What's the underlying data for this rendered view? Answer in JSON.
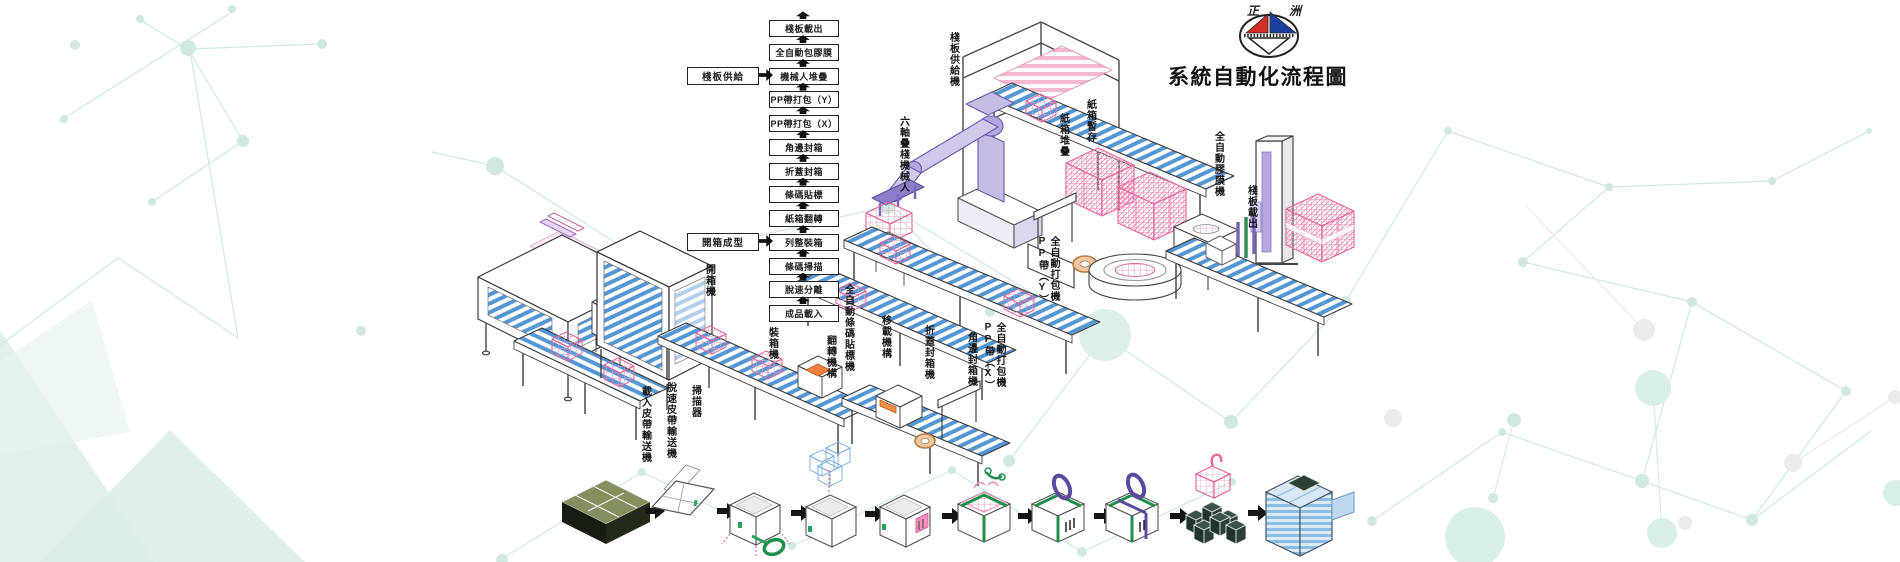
{
  "brand": {
    "logo_left": "正",
    "logo_right": "洲",
    "title": "系統自動化流程圖"
  },
  "flow_chart": {
    "steps": [
      "棧板載出",
      "全自動包膠膜",
      "機械人堆疊",
      "PP帶打包（Y）",
      "PP帶打包（X）",
      "角邊封箱",
      "折蓋封箱",
      "條碼貼標",
      "紙箱翻轉",
      "列整裝箱",
      "條碼掃描",
      "脫速分離",
      "成品載入"
    ],
    "inputs": [
      {
        "label": "棧板供給"
      },
      {
        "label": "開箱成型"
      }
    ]
  },
  "machine_labels": {
    "pallet_supply": "棧板供給機",
    "palletizing_robot": "六軸疊棧機械人",
    "carton_buffer": "紙箱暫存",
    "carton_stack": "紙箱堆疊",
    "film_wrapping_machine": "全自動膠膜機",
    "pallet_unload": "棧板載出",
    "pp_strapping_y_col1": "PP帶（Y）",
    "pp_strapping_y_col2": "全自動打包機",
    "pp_strapping_x_col1": "PP帶（X）",
    "pp_strapping_x_col2": "全自動打包機",
    "corner_edge_sealer": "角邊封箱機",
    "flap_fold_sealer": "折蓋封箱機",
    "transfer_unit": "移載機構",
    "auto_barcode_labeler": "全自動條碼貼標機",
    "flip_unit": "翻轉機構",
    "case_packer": "裝箱機",
    "case_opener": "開箱機",
    "scanner": "掃描器",
    "destack_belt_conveyor": "脫速皮帶輸送機",
    "infeed_belt_conveyor": "載入皮帶輸送機"
  },
  "process_flow_icons": [
    "flat-cardboard-stack",
    "folded-carton-blank",
    "carton-erect-taping",
    "product-loading",
    "barcode-labeling",
    "top-flap-sealing",
    "pp-strapping-x",
    "pp-strapping-y",
    "robot-palletizing",
    "stretch-wrapped-pallet"
  ],
  "colors": {
    "accent_teal": "#cfe8e2",
    "conveyor_blue": "#5596d4",
    "carton_pink": "#ef7fae",
    "robot_purple": "#8f7cc8",
    "tape_green": "#1f8f4d",
    "strap_purple": "#5b4aa0",
    "logo_red": "#cf2e26",
    "logo_blue": "#1d3f9e",
    "text": "#1c1c1c"
  }
}
